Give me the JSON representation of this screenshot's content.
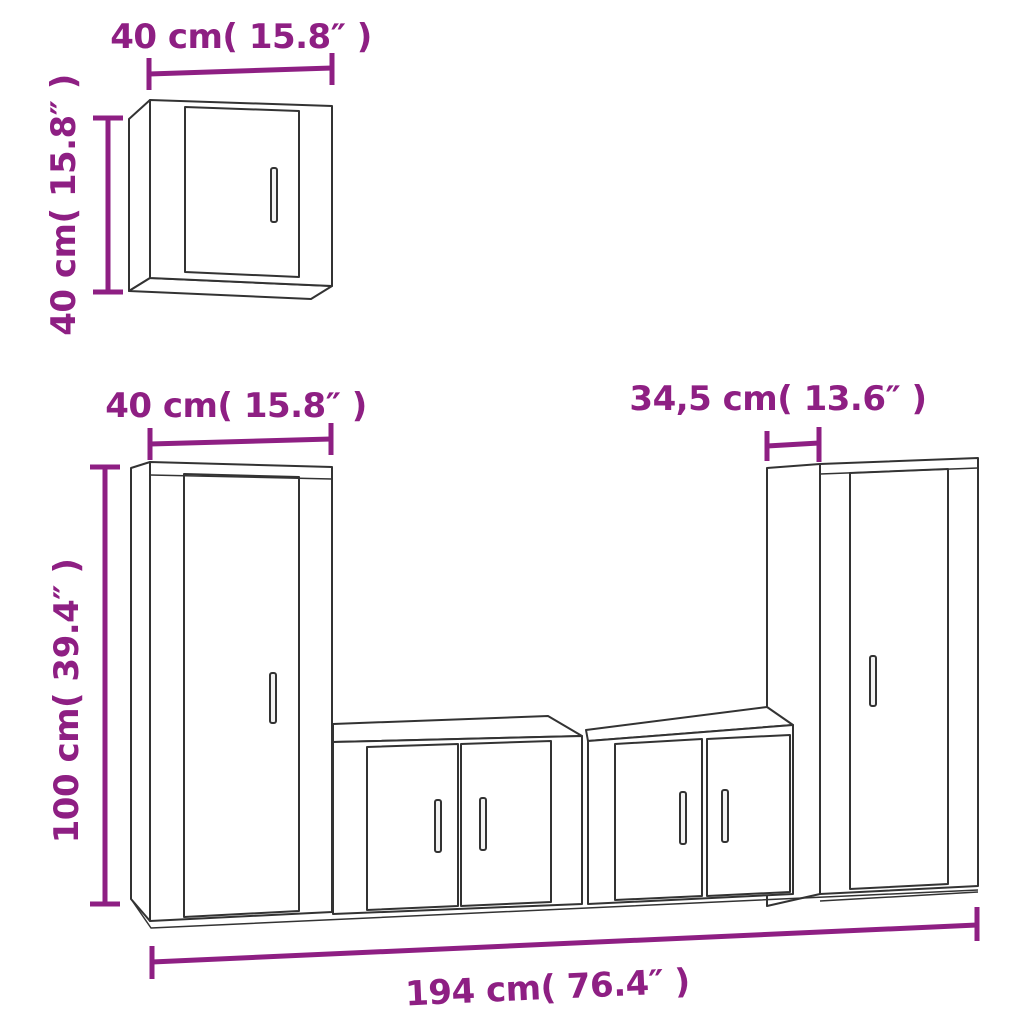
{
  "colors": {
    "accent": "#8e1f83",
    "line": "#333333",
    "face": "#ffffff",
    "handle_fill": "#f2f2f2"
  },
  "diagram": {
    "type": "furniture-dimension-diagram",
    "units": [
      "cm",
      "inches"
    ]
  },
  "labels": {
    "small_cabinet_width": "40 cm( 15.8″ )",
    "small_cabinet_height": "40 cm( 15.8″ )",
    "tall_cabinet_width": "40 cm( 15.8″ )",
    "tall_cabinet_height": "100 cm( 39.4″ )",
    "right_cabinet_depth": "34,5 cm( 13.6″ )",
    "total_width": "194 cm( 76.4″ )"
  }
}
